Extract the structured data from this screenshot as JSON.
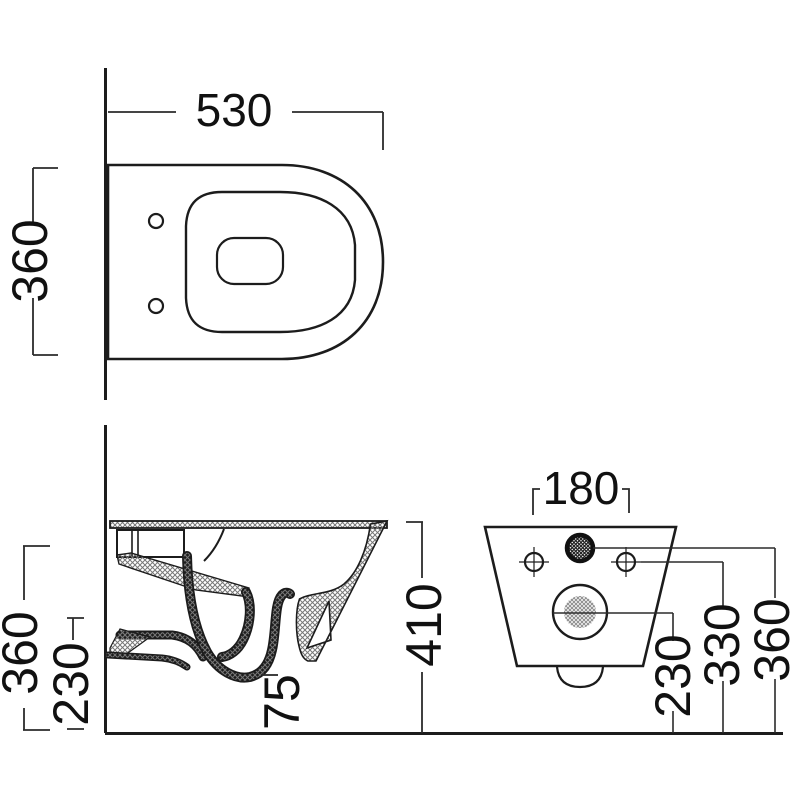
{
  "colors": {
    "background": "#ffffff",
    "line": "#1c1c1c",
    "dimension_line": "#2b2b2b",
    "hatch": "#777777",
    "hatch_dark": "#222222",
    "hatch_mid": "#8f8f8f"
  },
  "dimensions": {
    "plan": {
      "width": "530",
      "depth": "360"
    },
    "side": {
      "depth": "360",
      "lower_depth": "230",
      "outlet_offset": "75",
      "height": "410"
    },
    "rear": {
      "fixing_spacing": "180",
      "outlet_height": "230",
      "fixing_height": "330",
      "inlet_height": "360"
    }
  }
}
